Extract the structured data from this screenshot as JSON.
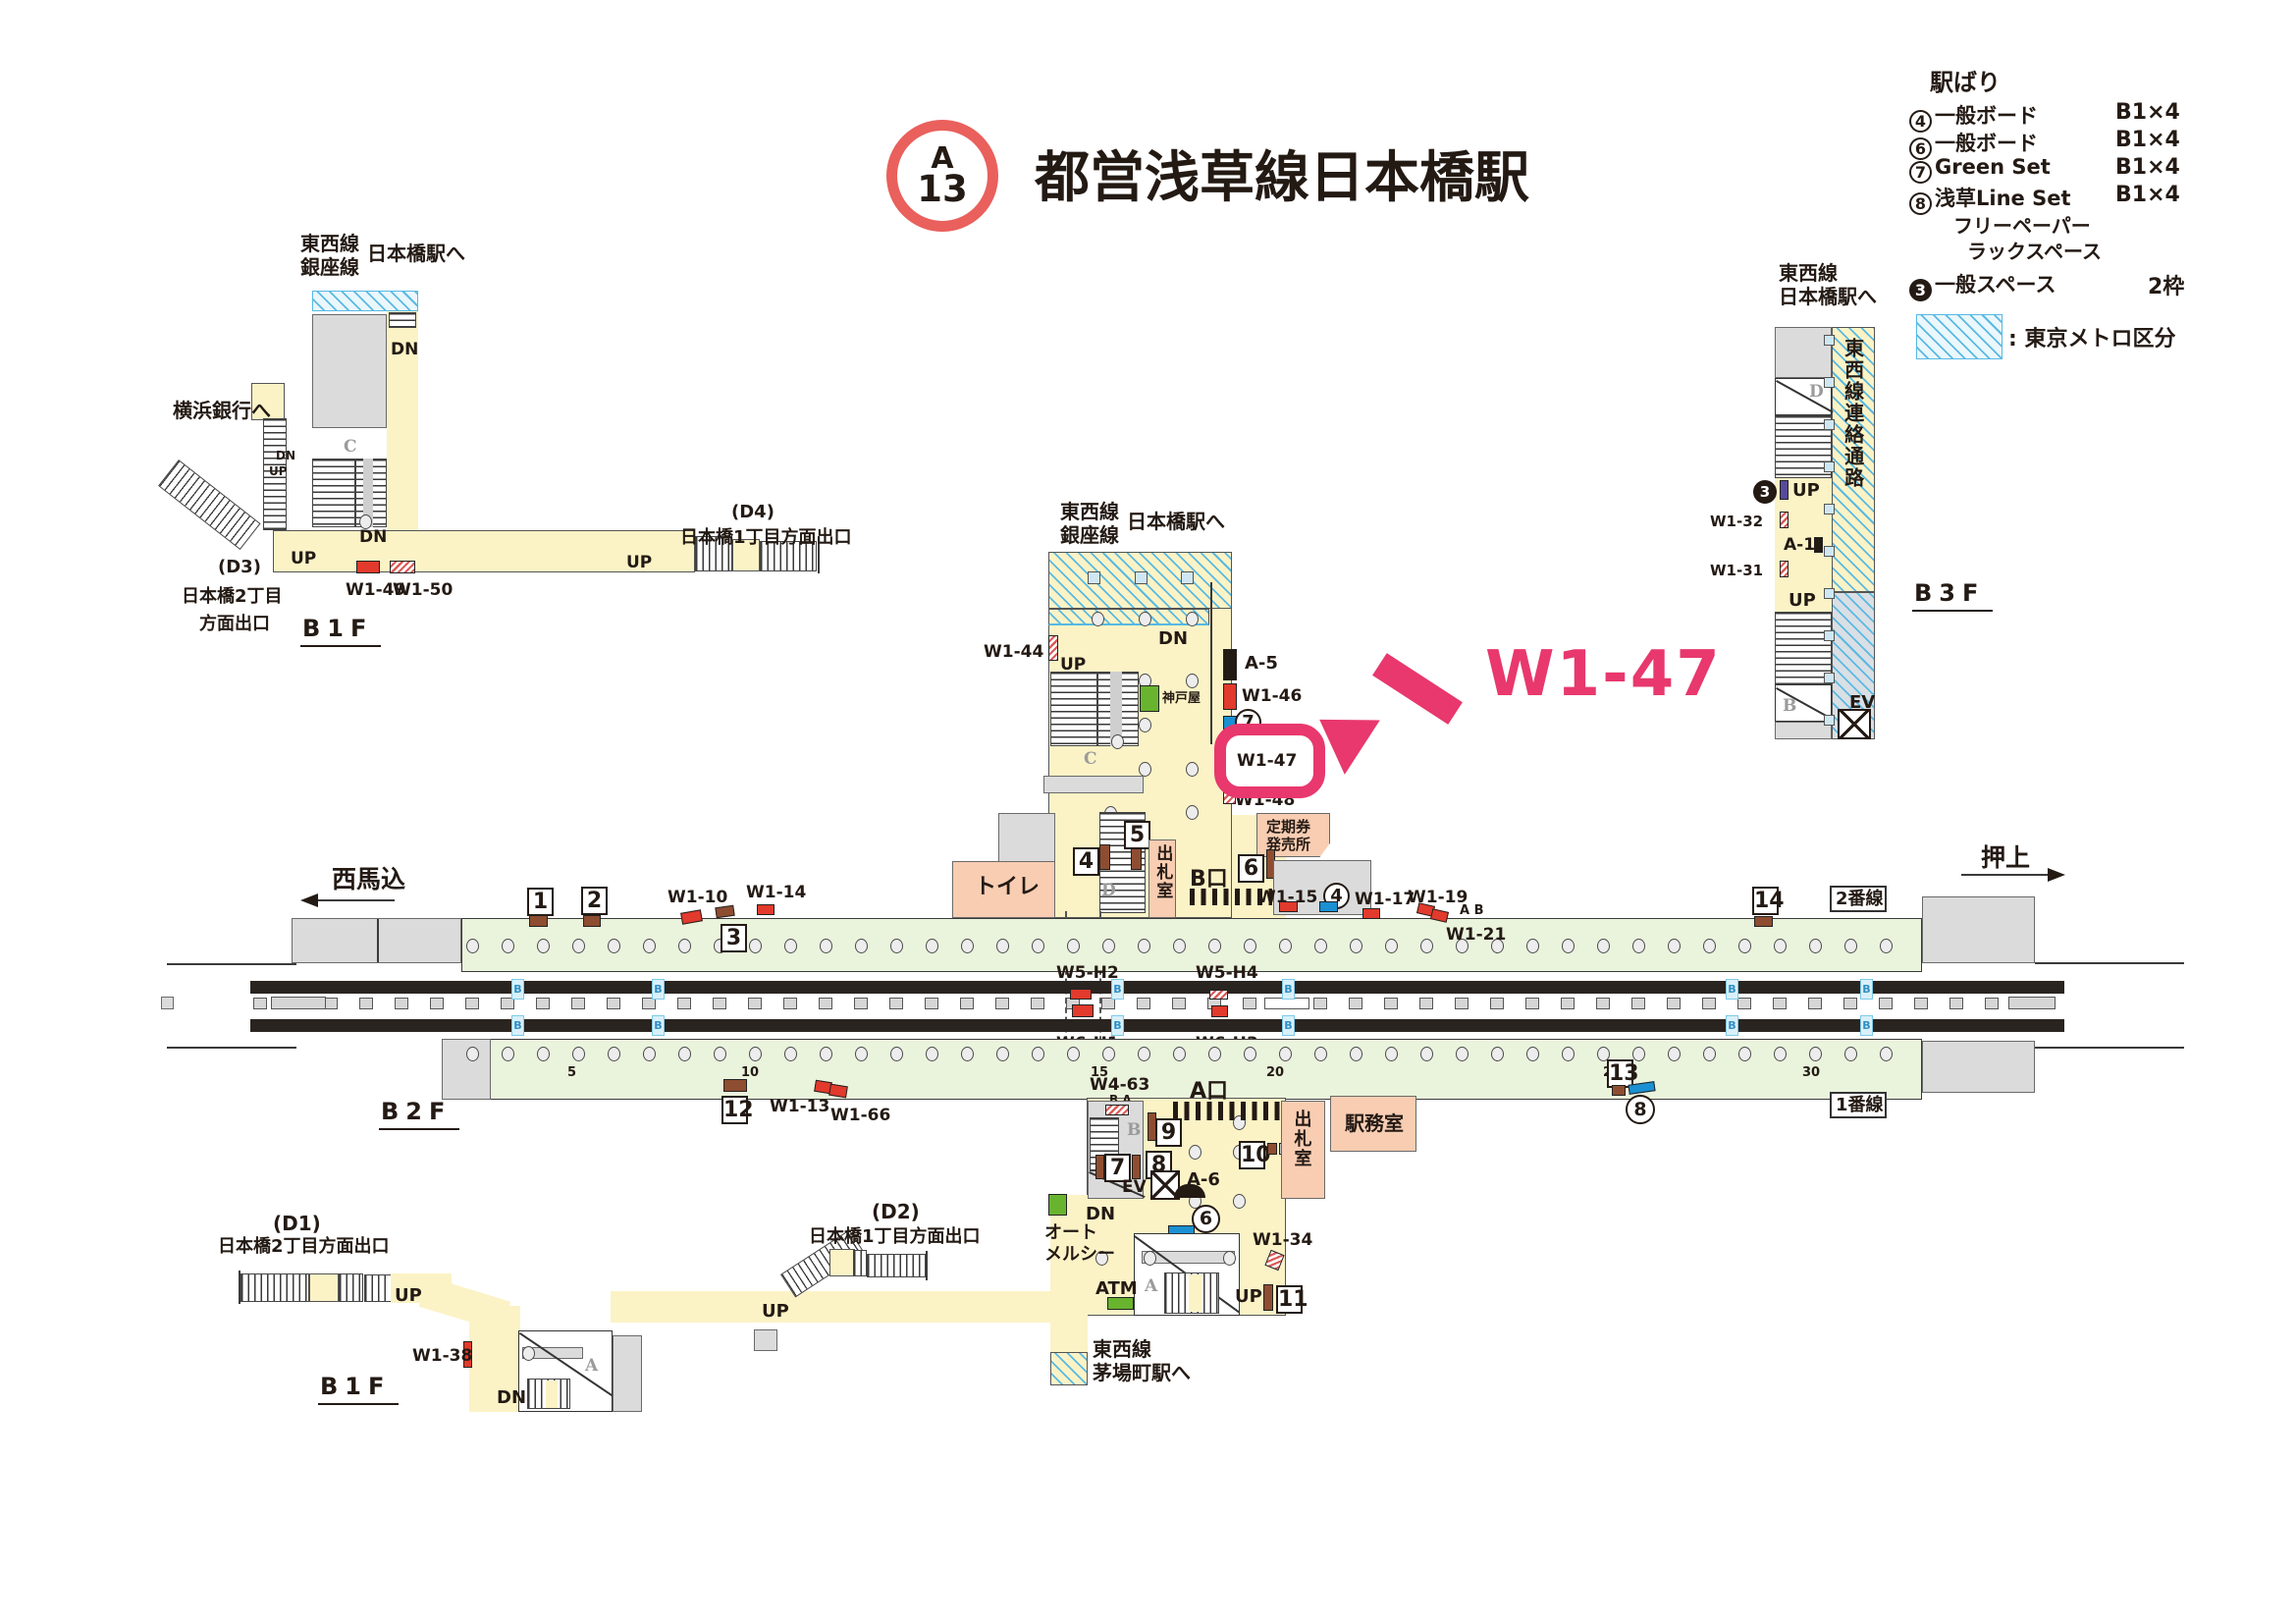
{
  "title": {
    "badge_letter": "A",
    "badge_number": "13",
    "station": "都営浅草線日本橋駅"
  },
  "legend": {
    "header": "駅ばり",
    "rows": [
      {
        "num": "4",
        "label": "一般ボード",
        "value": "B1×4"
      },
      {
        "num": "6",
        "label": "一般ボード",
        "value": "B1×4"
      },
      {
        "num": "7",
        "label": "Green Set",
        "value": "B1×4"
      },
      {
        "num": "8",
        "label": "浅草Line Set",
        "value": "B1×4"
      }
    ],
    "free_paper_line1": "フリーペーパー",
    "free_paper_line2": "ラックスペース",
    "general_space_num": "3",
    "general_space_label": "一般スペース",
    "general_space_value": "2枠",
    "metro_note": ": 東京メトロ区分",
    "metro_hatch_color": "#5ABAE2"
  },
  "b1f_nw": {
    "tozai": "東西線",
    "ginza": "銀座線",
    "to_nihombashi": "日本橋駅へ",
    "to_yokohama": "横浜銀行へ",
    "d3_code": "(D3)",
    "d3_line1": "日本橋2丁目",
    "d3_line2": "方面出口",
    "d4_code": "(D4)",
    "d4_line": "日本橋1丁目方面出口",
    "floor": "B1F",
    "w1_49": "W1-49",
    "w1_50": "W1-50",
    "up": "UP",
    "dn": "DN",
    "c": "C"
  },
  "b3f": {
    "head1": "東西線",
    "head2": "日本橋駅へ",
    "corridor": "東西線連絡通路",
    "n3": "3",
    "w1_32": "W1-32",
    "a_1": "A-1",
    "w1_31": "W1-31",
    "up": "UP",
    "d": "D",
    "b": "B",
    "ev": "EV",
    "floor": "B3F"
  },
  "concourse_top": {
    "tozai": "東西線",
    "ginza": "銀座線",
    "to_nihombashi": "日本橋駅へ",
    "dn": "DN",
    "up": "UP",
    "w1_44": "W1-44",
    "kobeya": "神戸屋",
    "a_5": "A-5",
    "w1_46": "W1-46",
    "n7": "7",
    "w1_47": "W1-47",
    "w1_48": "W1-48",
    "callout": "W1-47",
    "teiki_line1": "定期券",
    "teiki_line2": "発売所",
    "n4": "4",
    "n5": "5",
    "n6": "6",
    "b_gate": "B口",
    "shussatsu": "出札室",
    "toilet": "トイレ",
    "c": "C",
    "d": "D",
    "highlight_color": "#E8386D"
  },
  "platform": {
    "nishimagome": "西馬込",
    "oshiage": "押上",
    "n1": "1",
    "n2": "2",
    "n3": "3",
    "n12": "12",
    "n13": "13",
    "n14": "14",
    "c4": "4",
    "c8": "8",
    "w1_10": "W1-10",
    "w1_14": "W1-14",
    "w1_15": "W1-15",
    "w1_17": "W1-17",
    "w1_19": "W1-19",
    "w1_21": "W1-21",
    "ab": "A B",
    "w1_13": "W1-13",
    "w1_66": "W1-66",
    "w5_h2": "W5-H2",
    "w5_h4": "W5-H4",
    "w6_h1": "W6-H1",
    "w6_h3": "W6-H3",
    "line2": "2番線",
    "line1": "1番線",
    "p5": "5",
    "p10": "10",
    "p15": "15",
    "p20": "20",
    "p25": "25",
    "p30": "30",
    "floor": "B2F"
  },
  "concourse_bottom": {
    "w4_63": "W4-63",
    "ba": "B A",
    "a_gate": "A口",
    "n9": "9",
    "n10": "10",
    "n7": "7",
    "n8": "8",
    "n11": "11",
    "c6": "6",
    "ev": "EV",
    "a_6": "A-6",
    "dn": "DN",
    "up": "UP",
    "shussatsu": "出札室",
    "ekimushitsu": "駅務室",
    "auto1": "オート",
    "auto2": "メルシー",
    "w1_34": "W1-34",
    "atm": "ATM",
    "a": "A",
    "b": "B",
    "kayabacho1": "東西線",
    "kayabacho2": "茅場町駅へ"
  },
  "b1f_sw": {
    "d1_code": "(D1)",
    "d1_line": "日本橋2丁目方面出口",
    "d2_code": "(D2)",
    "d2_line": "日本橋1丁目方面出口",
    "up": "UP",
    "dn": "DN",
    "w1_38": "W1-38",
    "a": "A",
    "floor": "B1F"
  }
}
